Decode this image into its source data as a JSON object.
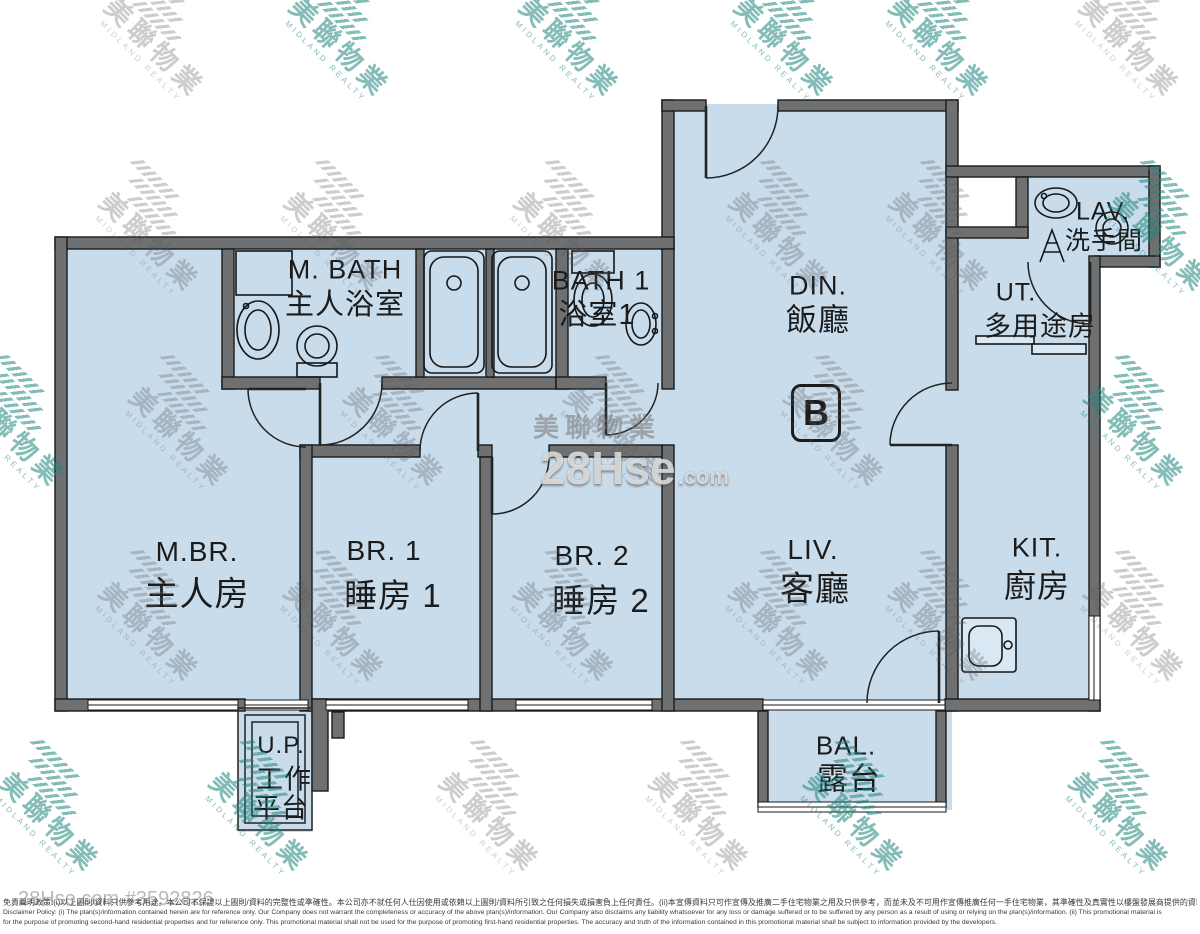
{
  "unit_badge": "B",
  "rooms": {
    "mbath": {
      "en": "M. BATH",
      "zh": "主人浴室"
    },
    "bath1": {
      "en": "BATH 1",
      "zh": "浴室1"
    },
    "din": {
      "en": "DIN.",
      "zh": "飯廳"
    },
    "lav": {
      "en": "LAV.",
      "zh": "洗手間"
    },
    "ut": {
      "en": "UT.",
      "zh": "多用途房"
    },
    "mbr": {
      "en": "M.BR.",
      "zh": "主人房"
    },
    "br1": {
      "en": "BR. 1",
      "zh": "睡房  1"
    },
    "br2": {
      "en": "BR. 2",
      "zh": "睡房  2"
    },
    "liv": {
      "en": "LIV.",
      "zh": "客廳"
    },
    "kit": {
      "en": "KIT.",
      "zh": "廚房"
    },
    "up": {
      "en": "U.P.",
      "zh1": "工作",
      "zh2": "平台"
    },
    "bal": {
      "en": "BAL.",
      "zh": "露台"
    }
  },
  "watermark": {
    "brand_zh": "美聯物業",
    "brand_en": "MIDLAND REALTY",
    "site_big": "28Hse",
    "site_tld": ".com",
    "listing_ref": "28Hse.com #3592826"
  },
  "footer": {
    "line_zh": "免責聲明政策:(i)以上圖則/資料只供參考用途。本公司不保證以上圖則/資料的完整性或準確性。本公司亦不就任何人仕因使用或依賴以上圖則/資料所引致之任何損失或損害負上任何責任。(ii)本宣傳資料只可作宣傳及推廣二手住宅物業之用及只供參考，而並未及不可用作宣傳推廣任何一手住宅物業，其準確性及真實性以樓盤發展商提供的資料為準。",
    "line_en1": "Disclaimer Policy: (i) The plan(s)/information contained herein are for reference only. Our Company does not warrant the completeness or accuracy of the above plan(s)/information. Our Company also disclaims any liability whatsoever for any loss or damage suffered or to be suffered by any person as a result of using or relying on the plan(s)/information. (ii) This promotional material is",
    "line_en2": "for the purpose of promoting second-hand residential properties and for reference only. This promotional material shall not be used for the purpose of promoting first-hand residential properties. The accuracy and truth of the information contained in this promotional material shall be subject to information provided by the developers."
  },
  "colors": {
    "room_fill": "#c9dcec",
    "wall": "#6e7072",
    "outline": "#1a1a1a"
  }
}
